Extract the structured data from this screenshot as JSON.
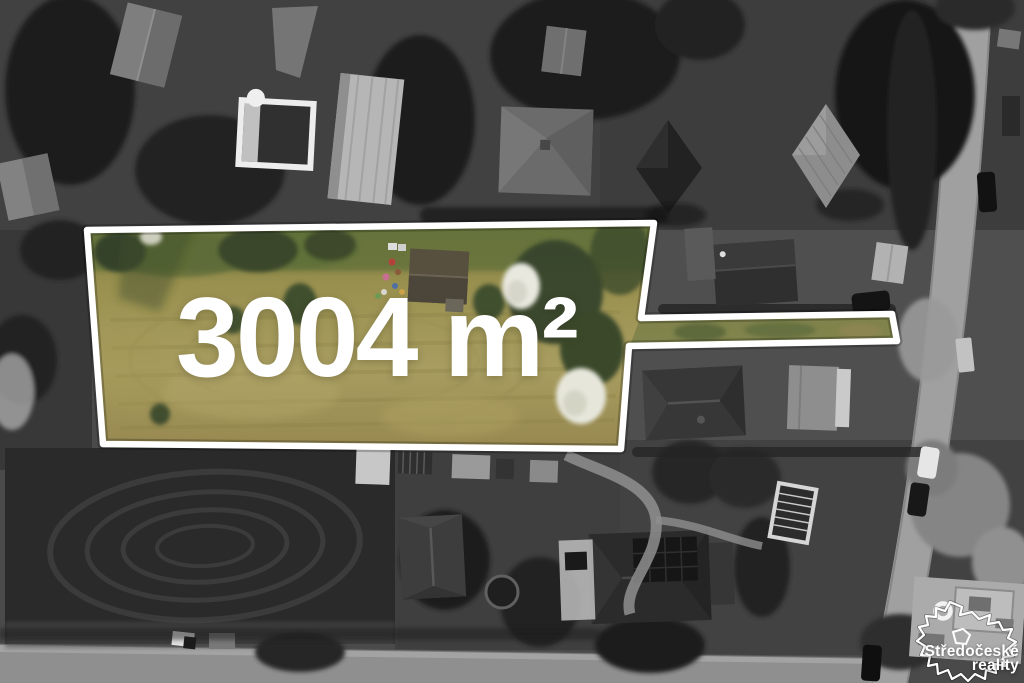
{
  "overlay": {
    "area_label": "3004 m²",
    "outline_color": "#ffffff"
  },
  "branding": {
    "line1": "Středočeské",
    "line2": "reality",
    "text_color": "#ffffff"
  },
  "scene": {
    "plot_colors": {
      "grass_tan": "#a89d60",
      "grass_green": "#687539",
      "tree_green": "#36432a",
      "blossom_white": "#e8e8df",
      "cabin_roof": "#57503f"
    },
    "surroundings_colors": {
      "road_gray": "#9b9b9b",
      "field_dark": "#2a2a2a",
      "tree_dark": "#1c1c1c"
    }
  }
}
